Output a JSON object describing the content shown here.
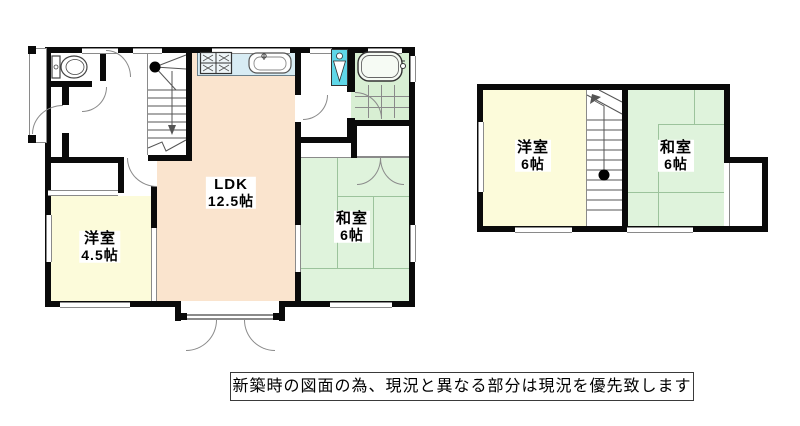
{
  "caption": {
    "text": "新築時の図面の為、現況と異なる部分は現況を優先致します"
  },
  "floor1": {
    "rooms": [
      {
        "id": "ldk",
        "label": "LDK",
        "size": "12.5帖"
      },
      {
        "id": "western-4-5",
        "label": "洋室",
        "size": "4.5帖"
      },
      {
        "id": "japanese-6",
        "label": "和室",
        "size": "6帖"
      }
    ],
    "fixtures": [
      "toilet",
      "staircase",
      "kitchen-stove",
      "kitchen-sink",
      "washing-machine",
      "bathtub"
    ]
  },
  "floor2": {
    "rooms": [
      {
        "id": "western-6",
        "label": "洋室",
        "size": "6帖"
      },
      {
        "id": "japanese-6",
        "label": "和室",
        "size": "6帖"
      }
    ],
    "fixtures": [
      "staircase"
    ]
  },
  "colors": {
    "wall": "#0a0a0a",
    "ldk_floor": "#FAE4CE",
    "western_room_floor": "#FCFBDA",
    "tatami_floor": "#DFF3DC",
    "bathroom_floor": "#D8EFD3",
    "kitchen_counter": "#D8ECF4",
    "washing_machine": "#5FD7E8",
    "thin_line": "#8A8A8A"
  }
}
